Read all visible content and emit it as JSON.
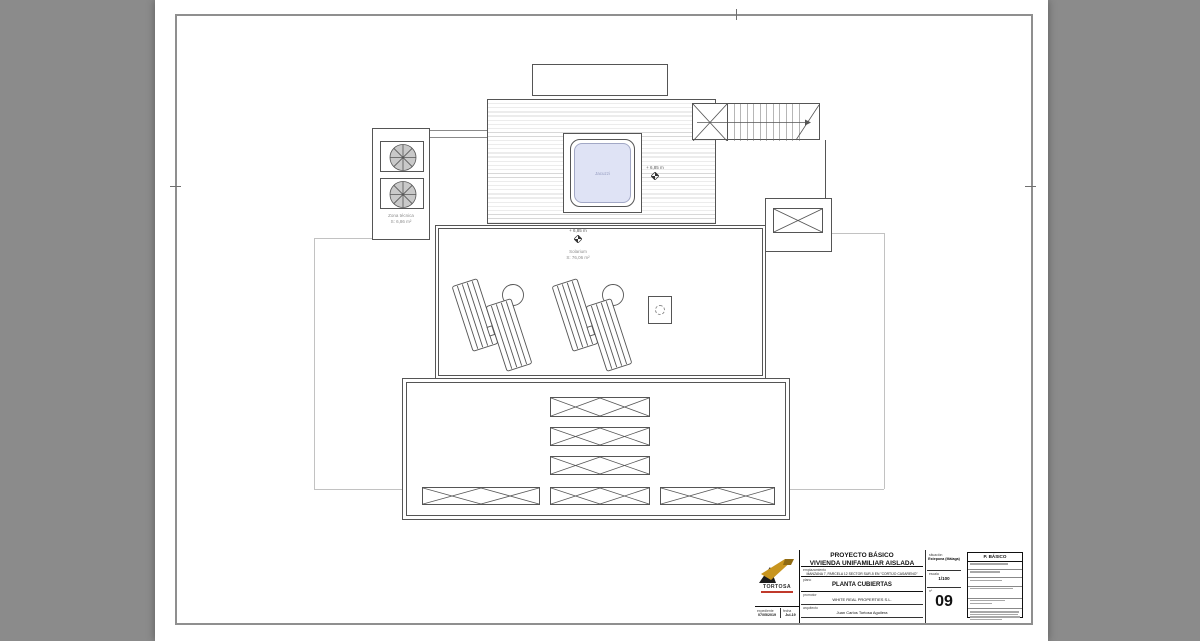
{
  "plan": {
    "zona_tecnica": {
      "label": "Zona técnica",
      "area": "S: 6,86 m²"
    },
    "jacuzzi": {
      "label": "Jacuzzi"
    },
    "deck_level": "+ 6,85 m",
    "solarium": {
      "level": "+ 6,85 m",
      "label": "Solarium",
      "area": "S: 76,06 m²"
    }
  },
  "title_block": {
    "logo_text": "TORTOSA",
    "project_line1": "PROYECTO BÁSICO",
    "project_line2": "VIVIENDA UNIFAMILIAR AISLADA",
    "labels": {
      "emplazamiento": "emplazamiento",
      "plano": "plano",
      "promotor": "promotor",
      "arquitecto": "arquitecto",
      "situacion": "situación",
      "escala": "escala",
      "numero": "nº",
      "expediente": "expediente",
      "fecha": "fecha"
    },
    "emplazamiento": "MANZANA 7, PARCELA 12 SECTOR SUR-5 EN \"CORTIJO CASARENO\"",
    "plano": "PLANTA CUBIERTAS",
    "promotor": "WHITE REAL PROPERTIES S.L.",
    "arquitecto": "Juan Carlos Tortosa Aguilera",
    "situacion": "Estepona (Málaga)",
    "escala": "1/100",
    "numero": "09",
    "expediente": "07/05/2019",
    "fecha": "Jul-19",
    "revision_title": "P. BÁSICO"
  },
  "colors": {
    "background": "#8b8b8b",
    "water": "#dfe3f5",
    "logo_gold": "#c8951f",
    "logo_red": "#c0392b",
    "line": "#555555"
  }
}
